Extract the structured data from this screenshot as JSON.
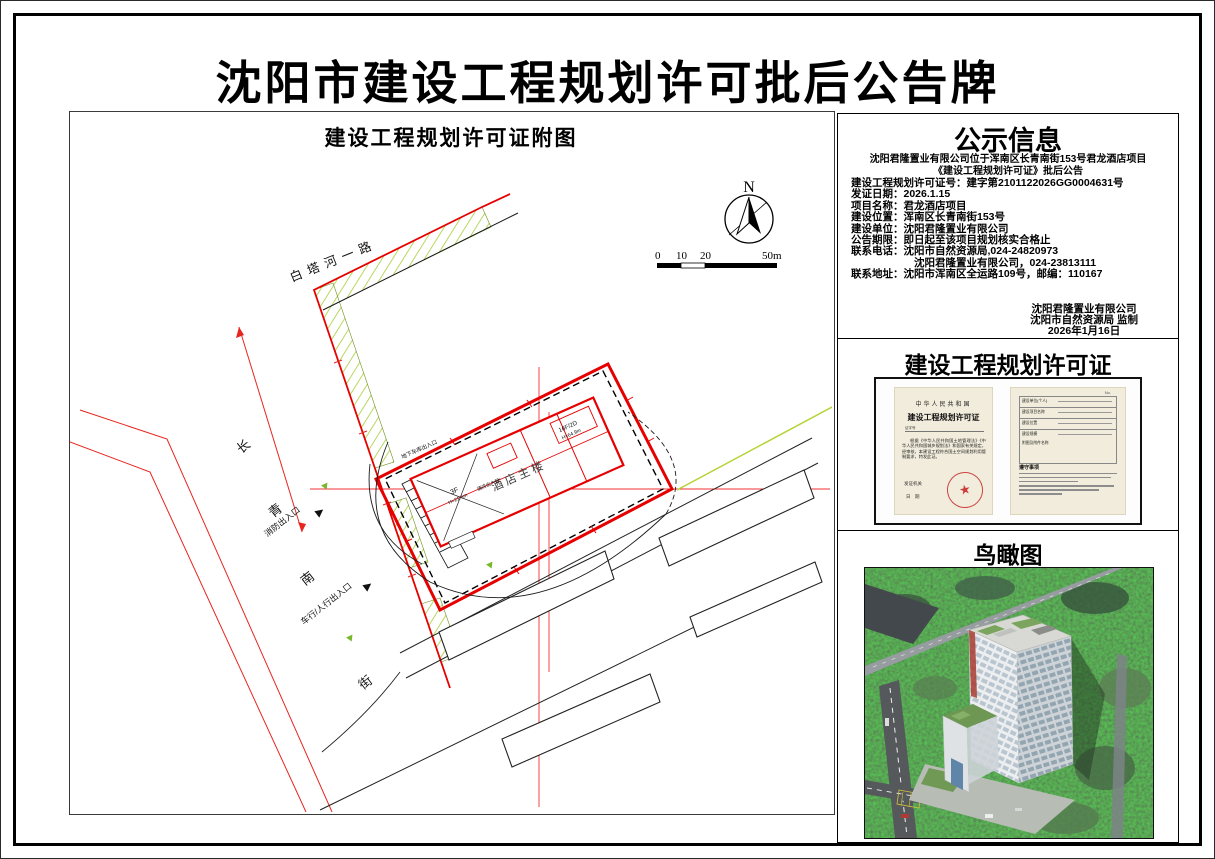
{
  "title": "沈阳市建设工程规划许可批后公告牌",
  "plan": {
    "title": "建设工程规划许可证附图",
    "compass": "N",
    "scale_ticks": [
      "0",
      "10",
      "20",
      "50m"
    ],
    "roads": {
      "baita": "白塔河一路",
      "changqing": [
        "长",
        "青",
        "南",
        "街"
      ]
    },
    "labels": {
      "building": "酒店主楼",
      "fire_entrance": "消防出入口",
      "vehicle_entrance": "车行/人行出入口",
      "garage_entrance": "地下车库出入口",
      "hotel_entrance": "酒店出入口",
      "podium_floors": "3F",
      "podium_height": "H=21.6m",
      "tower_floors": "16F/2D",
      "tower_height": "H=64.9m"
    }
  },
  "notice": {
    "title": "公示信息",
    "subtitle_line1": "沈阳君隆置业有限公司位于浑南区长青南街153号君龙酒店项目",
    "subtitle_line2": "《建设工程规划许可证》批后公告",
    "fields": [
      {
        "label": "建设工程规划许可证号：",
        "value": "建字第2101122026GG0004631号"
      },
      {
        "label": "发证日期：",
        "value": "2026.1.15"
      },
      {
        "label": "项目名称：",
        "value": "君龙酒店项目"
      },
      {
        "label": "建设位置：",
        "value": "浑南区长青南街153号"
      },
      {
        "label": "建设单位：",
        "value": "沈阳君隆置业有限公司"
      },
      {
        "label": "公告期限：",
        "value": "即日起至该项目规划核实合格止"
      },
      {
        "label": "联系电话：",
        "value": "沈阳市自然资源局,024-24820973"
      },
      {
        "label": "",
        "value": "沈阳君隆置业有限公司，024-23813111"
      },
      {
        "label": "联系地址：",
        "value": "沈阳市浑南区全运路109号，邮编：110167"
      }
    ],
    "footer": [
      "沈阳君隆置业有限公司",
      "沈阳市自然资源局 监制",
      "2026年1月16日"
    ]
  },
  "permit": {
    "title": "建设工程规划许可证",
    "page_left": {
      "country": "中华人民共和国",
      "cert_title": "建设工程规划许可证",
      "no_label": "证字号",
      "body": "根据《中华人民共和国土地管理法》《中华人民共和国城乡规划法》和国家有关规定，经审核，本建设工程符合国土空间规划利用管制要求，特发此证。",
      "issuer_label": "发证机关",
      "date_label": "日　期"
    },
    "page_right": {
      "no": "No.",
      "fields": [
        "建设单位(个人)",
        "建设项目名称",
        "建设位置",
        "建设规模",
        "附图及附件名称"
      ],
      "notes_title": "遵守事项"
    }
  },
  "aerial": {
    "title": "鸟瞰图"
  }
}
